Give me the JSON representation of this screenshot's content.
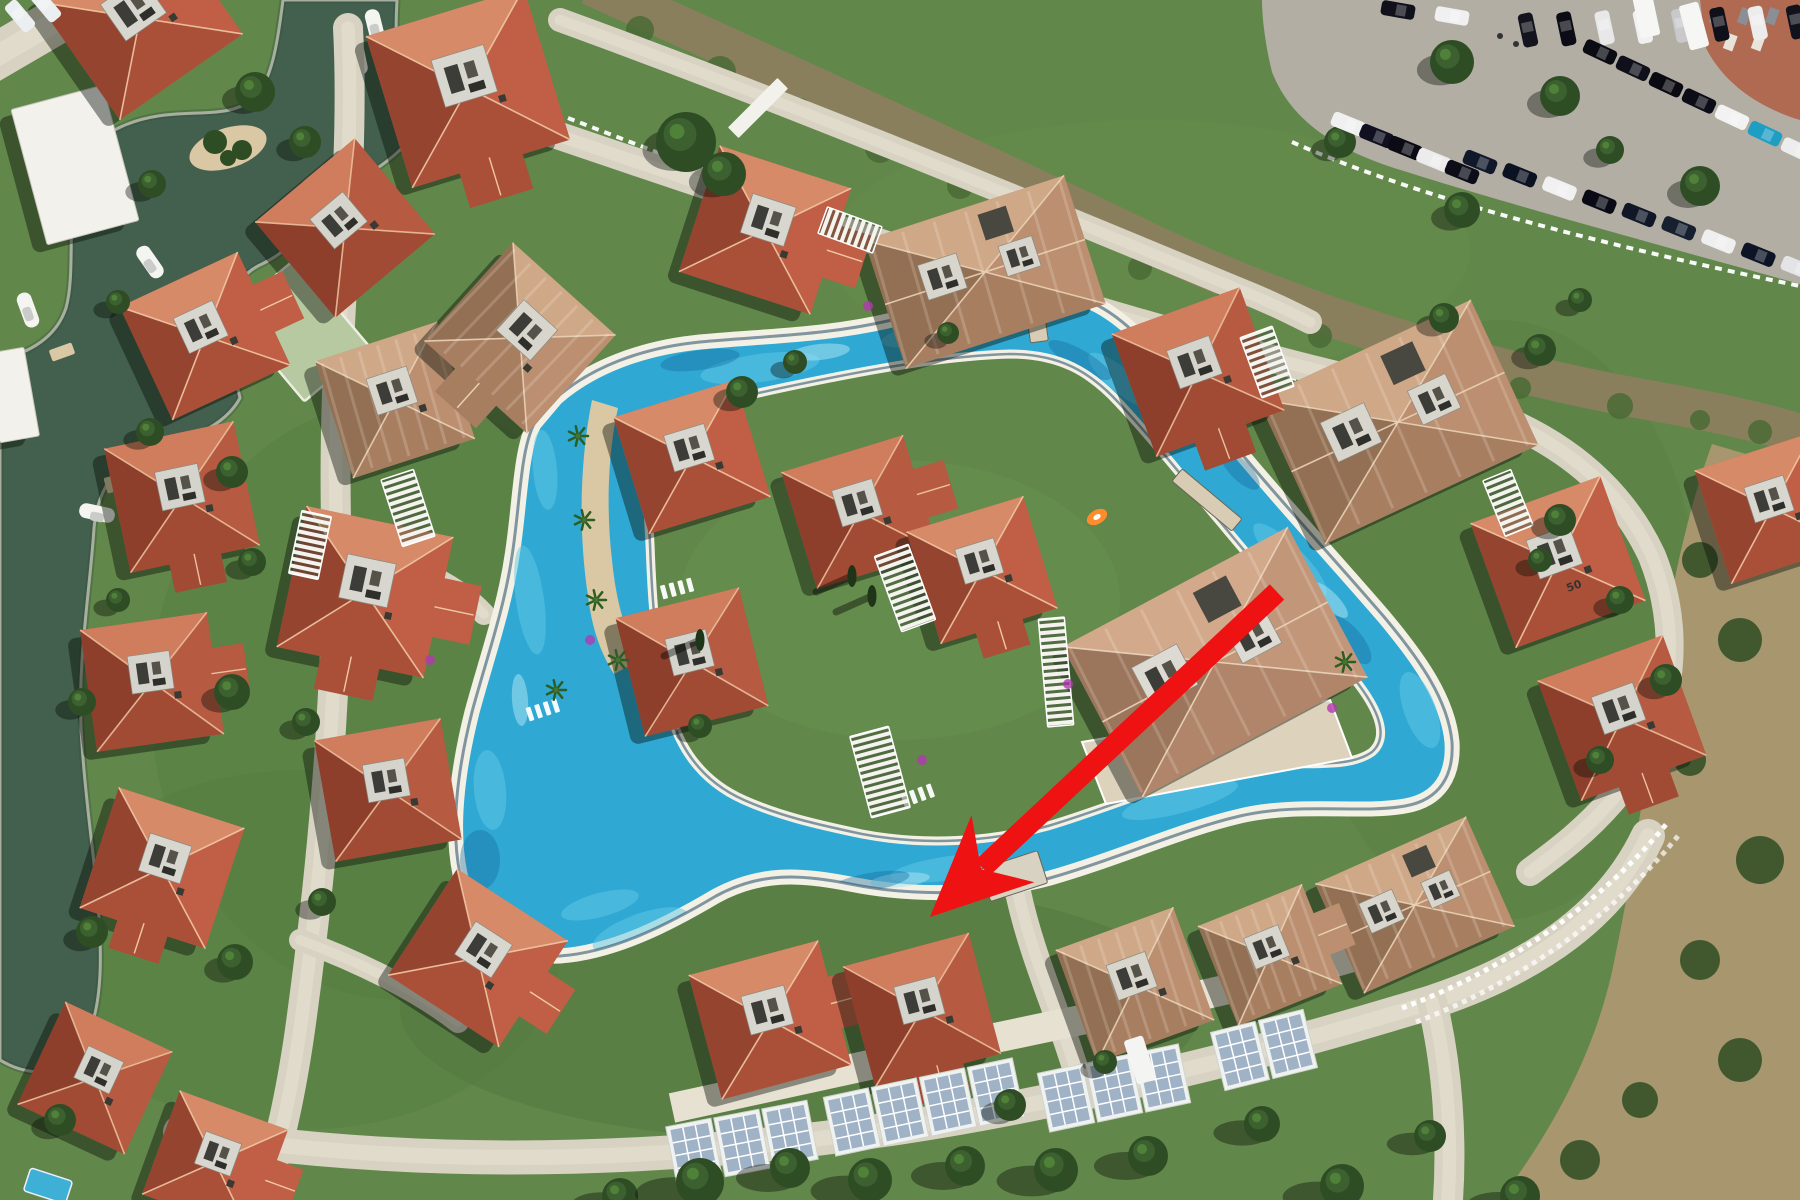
{
  "scene": {
    "w": 1800,
    "h": 1200,
    "description": "aerial-photo-of-resort-with-lazy-river-pool-and-red-arrow"
  },
  "labels": {
    "villa_number": "50"
  },
  "colors": {
    "lawn": "#61874a",
    "lawnDark": "#4e7038",
    "lawnLight": "#719a54",
    "road": "#d8d2c2",
    "roadLight": "#e7e1d2",
    "poolWater": "#2fa9d4",
    "poolLight": "#62c8e6",
    "poolPale": "#a5e2f1",
    "poolDark": "#14699b",
    "coping": "#f3f1e6",
    "poolEdge": "#0f3a58",
    "lagoon": "#435f4d",
    "lagoonDark": "#35503f",
    "sand": "#d9c8a3",
    "creek": "#8a7f5c",
    "asphalt": "#b2aea4",
    "brick": "#b06a52",
    "scrub": "#a7966e",
    "terrace": "#ddd3bd",
    "white": "#f2f1ec",
    "shadow": "rgba(8,14,6,0.42)",
    "arrow": "#ee1212",
    "court": "#b7c9a0",
    "panel": "#9fb2c6",
    "panelFrame": "#f0f2f0",
    "treeDark": "#2f4d24",
    "treeMid": "#3c6030",
    "treeLight": "#558a3b",
    "cypress": "#1e3518",
    "purple": "#b03ab0",
    "carDark": "#10101c",
    "boat": "#f4f4f0"
  },
  "palettes": [
    {
      "base": "#c2664c",
      "f": [
        "#d68a68",
        "#c05f45",
        "#ab5038",
        "#95442f"
      ],
      "ridge": "#f0c8a6",
      "court": "#d7d7cf"
    },
    {
      "base": "#b55a42",
      "f": [
        "#cf7d5c",
        "#b65a41",
        "#a14b35",
        "#8d3f2c"
      ],
      "ridge": "#eabf9d",
      "court": "#d4d4cc"
    },
    {
      "base": "#b08266",
      "f": [
        "#cfa888",
        "#bb8f70",
        "#a87e61",
        "#937054"
      ],
      "ridge": "#ead2b5",
      "court": "#d7d5cc"
    },
    {
      "base": "#c29b7e",
      "f": [
        "#d3a98c",
        "#c29679",
        "#b08569",
        "#9c765c"
      ],
      "ridge": "#ecd6bd",
      "court": "#dcdad2"
    }
  ],
  "lawn_patches": [
    [
      900,
      600,
      300,
      200,
      "#6d9350",
      0.3
    ],
    [
      400,
      700,
      250,
      300,
      "#547a3e",
      0.35
    ],
    [
      1500,
      620,
      200,
      300,
      "#55793e",
      0.3
    ],
    [
      800,
      1010,
      400,
      130,
      "#4e7038",
      0.35
    ],
    [
      1150,
      250,
      320,
      130,
      "#6d9350",
      0.3
    ],
    [
      300,
      950,
      260,
      180,
      "#547a3e",
      0.3
    ]
  ],
  "lagoon": {
    "path": "M 283 0 L 397 0 C 394 52 398 96 418 128 C 400 158 368 172 338 198 C 312 222 292 250 262 264 C 244 272 234 286 230 310 C 228 344 234 372 240 398 C 224 428 186 440 148 452 C 118 462 98 486 94 528 C 90 592 76 668 82 744 C 86 812 98 876 100 940 C 102 992 96 1032 74 1058 C 52 1080 20 1072 0 1060 L 0 360 C 30 352 56 338 66 308 C 76 272 66 214 78 172 C 88 140 120 122 158 116 C 196 110 228 118 252 100 C 272 84 278 40 283 0 Z",
    "island": {
      "x": 228,
      "y": 148,
      "rx": 40,
      "ry": 20,
      "rot": -18
    },
    "island_trees": [
      [
        215,
        142,
        12
      ],
      [
        242,
        150,
        10
      ],
      [
        228,
        158,
        8
      ]
    ],
    "docks": [
      [
        318,
        178,
        -40,
        30,
        14
      ],
      [
        120,
        482,
        -15,
        30,
        16
      ],
      [
        62,
        352,
        -20,
        24,
        12
      ]
    ],
    "boats": [
      [
        358,
        57,
        -12
      ],
      [
        375,
        27,
        -14
      ],
      [
        150,
        262,
        -35
      ],
      [
        97,
        513,
        -78
      ],
      [
        28,
        310,
        -20
      ]
    ]
  },
  "creek": {
    "path": "M 590 -15 C 760 62 960 152 1160 248 C 1320 322 1500 374 1648 400 C 1716 412 1770 424 1805 436",
    "width": 40,
    "blobs": [
      [
        640,
        30,
        14
      ],
      [
        720,
        72,
        16
      ],
      [
        800,
        110,
        12
      ],
      [
        880,
        148,
        15
      ],
      [
        960,
        186,
        13
      ],
      [
        1050,
        226,
        16
      ],
      [
        1140,
        268,
        12
      ],
      [
        1230,
        302,
        15
      ],
      [
        1320,
        336,
        12
      ],
      [
        1420,
        364,
        14
      ],
      [
        1520,
        388,
        11
      ],
      [
        1620,
        406,
        13
      ],
      [
        1700,
        420,
        10
      ],
      [
        1760,
        432,
        12
      ]
    ],
    "fences": [
      "M 568 118 C 770 196 985 278 1205 352 C 1330 392 1440 414 1540 428",
      "M 1292 142 C 1400 190 1560 236 1800 286"
    ]
  },
  "court": {
    "x": 300,
    "y": 330,
    "rot": -40,
    "w": 85,
    "h": 115
  },
  "roads": [
    {
      "d": "M -10 60 L 110 -10",
      "w": 46
    },
    {
      "d": "M 348 28 C 356 180 332 330 336 520 C 340 700 318 900 300 1030 C 290 1100 278 1150 262 1200",
      "w": 30
    },
    {
      "d": "M 180 1132 C 480 1180 800 1156 1080 1094 C 1260 1054 1360 1024 1432 1002 C 1540 966 1612 912 1648 836",
      "w": 34
    },
    {
      "d": "M 1432 1002 C 1448 1068 1452 1140 1448 1200",
      "w": 30
    },
    {
      "d": "M 548 132 C 760 204 980 278 1180 334 C 1290 364 1360 382 1428 396 C 1530 418 1612 470 1652 556 C 1688 646 1666 738 1612 800 C 1586 830 1560 850 1530 872",
      "w": 28
    },
    {
      "d": "M 560 20 C 780 100 1000 190 1240 290 C 1270 302 1290 312 1310 322",
      "w": 24
    },
    {
      "d": "M 336 548 C 404 560 452 580 484 614",
      "w": 22
    },
    {
      "d": "M 300 940 C 360 962 420 992 458 1022",
      "w": 22
    },
    {
      "d": "M 988 742 C 1000 790 1008 838 1016 882 C 1026 936 1048 990 1066 1040 C 1074 1064 1080 1082 1084 1096",
      "w": 26
    }
  ],
  "plaza": "M 756 538 L 985 598 L 1005 700 L 930 762 L 792 748 L 742 640 Z",
  "terrace": "M 1082 742 L 1330 700 L 1352 758 L 1106 804 Z",
  "walkway": "M 672 1108 C 820 1076 980 1040 1140 1008 C 1240 988 1330 966 1420 936",
  "parking": {
    "path": "M 1262 0 L 1800 0 L 1800 284 C 1640 240 1480 196 1388 166 C 1330 146 1290 118 1272 72 C 1266 48 1262 20 1262 0 Z",
    "brick": "M 1700 0 L 1800 0 L 1800 120 C 1760 108 1724 84 1706 48 Z",
    "rows": [
      {
        "x1": 1528,
        "y1": 30,
        "x2": 1796,
        "y2": 22,
        "n": 8,
        "rot": -12,
        "colors": [
          "#14141e",
          "#0c0c16",
          "#e8e8e8",
          "#f0f0f0",
          "#c9c9cc",
          "#10101a",
          "#ececec",
          "#12121c"
        ]
      },
      {
        "x1": 1600,
        "y1": 52,
        "x2": 1798,
        "y2": 150,
        "n": 7,
        "rot": 115,
        "colors": [
          "#0b0b14",
          "#10101c",
          "#0a0a12",
          "#0d0d18",
          "#f2f2f2",
          "#1f9ec4",
          "#ededed"
        ]
      },
      {
        "x1": 1348,
        "y1": 124,
        "x2": 1462,
        "y2": 172,
        "n": 5,
        "rot": 112,
        "colors": [
          "#f0f0f0",
          "#101020",
          "#0b0b16",
          "#ececec",
          "#0d0d1a"
        ]
      },
      {
        "x1": 1480,
        "y1": 162,
        "x2": 1798,
        "y2": 268,
        "n": 9,
        "rot": 112,
        "colors": [
          "#10182a",
          "#0b1222",
          "#f1f1f1",
          "#0a0a16",
          "#101828",
          "#16202f",
          "#efefef",
          "#0c1426",
          "#e4e4e6"
        ]
      },
      {
        "x1": 1398,
        "y1": 10,
        "x2": 1452,
        "y2": 16,
        "n": 2,
        "rot": 100,
        "colors": [
          "#11111c",
          "#f0f0f0"
        ]
      }
    ],
    "vans": [
      [
        1646,
        14,
        -12
      ],
      [
        1694,
        26,
        -15
      ]
    ],
    "trees": [
      [
        1452,
        62,
        22
      ],
      [
        1560,
        96,
        20
      ],
      [
        1340,
        142,
        16
      ],
      [
        1462,
        210,
        18
      ],
      [
        1700,
        186,
        20
      ],
      [
        1610,
        150,
        14
      ]
    ],
    "people": [
      [
        1500,
        36
      ],
      [
        1516,
        44
      ]
    ]
  },
  "scrub": {
    "path": "M 1712 444 L 1800 470 L 1800 1200 L 1500 1200 C 1560 1120 1600 1040 1616 952 C 1636 856 1648 760 1660 664 C 1672 580 1690 504 1712 444 Z",
    "blobs": [
      [
        1700,
        560,
        18
      ],
      [
        1740,
        640,
        22
      ],
      [
        1690,
        760,
        16
      ],
      [
        1760,
        860,
        24
      ],
      [
        1700,
        960,
        20
      ],
      [
        1740,
        1060,
        22
      ],
      [
        1640,
        1100,
        18
      ],
      [
        1580,
        1160,
        20
      ],
      [
        1772,
        500,
        14
      ]
    ]
  },
  "pool": {
    "outer": "M 556 398 C 590 368 640 348 700 342 C 760 336 830 336 900 318 C 945 306 990 294 1032 292 C 1080 290 1110 308 1140 338 C 1170 368 1205 410 1240 452 C 1285 506 1335 560 1385 618 C 1420 660 1448 700 1452 742 C 1454 775 1440 800 1405 806 C 1360 814 1300 802 1240 816 C 1180 830 1120 858 1050 878 C 990 894 920 898 850 884 C 800 874 760 872 716 896 C 672 922 616 952 560 956 C 512 958 472 928 460 874 C 450 826 458 768 472 712 C 486 660 504 610 512 556 C 520 506 520 452 534 424 Z",
    "island": "M 648 428 C 700 404 760 392 830 378 C 890 366 950 356 1010 354 C 1060 354 1090 372 1118 402 C 1150 436 1185 480 1222 524 C 1265 576 1310 626 1352 676 C 1378 708 1390 736 1372 752 C 1344 772 1290 758 1232 768 C 1170 780 1115 806 1048 826 C 990 842 925 846 862 834 C 815 824 780 816 744 800 C 708 784 682 756 670 712 C 656 660 652 600 650 544 C 648 504 644 462 648 428 Z",
    "peninsula": "M 592 400 C 580 460 578 530 588 596 C 592 628 600 652 614 674 L 640 660 C 624 630 616 600 612 560 C 606 510 608 452 618 408 Z",
    "palms": [
      [
        578,
        436
      ],
      [
        584,
        520
      ],
      [
        596,
        600
      ],
      [
        618,
        660
      ],
      [
        556,
        690
      ],
      [
        1345,
        662
      ]
    ],
    "sparkles": [
      [
        760,
        368,
        60,
        14,
        -8
      ],
      [
        950,
        330,
        70,
        13,
        -10
      ],
      [
        1120,
        380,
        40,
        12,
        40
      ],
      [
        1290,
        560,
        50,
        14,
        45
      ],
      [
        1420,
        710,
        40,
        16,
        70
      ],
      [
        1180,
        800,
        60,
        13,
        -15
      ],
      [
        950,
        868,
        60,
        12,
        -8
      ],
      [
        640,
        930,
        50,
        16,
        -20
      ],
      [
        490,
        790,
        16,
        40,
        -5
      ],
      [
        530,
        600,
        14,
        55,
        -8
      ],
      [
        545,
        470,
        12,
        40,
        -5
      ],
      [
        600,
        905,
        40,
        12,
        -15
      ]
    ],
    "pales": [
      [
        820,
        352,
        30,
        8,
        -6
      ],
      [
        1000,
        310,
        34,
        7,
        -8
      ],
      [
        1330,
        600,
        24,
        8,
        45
      ],
      [
        900,
        880,
        30,
        7,
        -6
      ],
      [
        520,
        700,
        8,
        26,
        -4
      ]
    ],
    "darks": [
      [
        700,
        360,
        40,
        10,
        -8
      ],
      [
        1080,
        360,
        36,
        10,
        30
      ],
      [
        1350,
        640,
        30,
        12,
        50
      ],
      [
        870,
        882,
        40,
        9,
        -10
      ],
      [
        480,
        860,
        20,
        30,
        0
      ],
      [
        1240,
        470,
        26,
        10,
        45
      ]
    ],
    "bridges": [
      [
        1035,
        310,
        -8,
        18,
        64,
        0
      ],
      [
        1207,
        500,
        -50,
        16,
        78,
        0
      ],
      [
        1014,
        876,
        72,
        34,
        60,
        1
      ]
    ],
    "loungers": [
      [
        452,
        428,
        -80
      ],
      [
        530,
        714,
        -18
      ],
      [
        664,
        592,
        -15
      ],
      [
        905,
        800,
        -20
      ]
    ],
    "float": {
      "x": 1097,
      "y": 517,
      "color": "#ff8c2a"
    }
  },
  "solar": {
    "panels": [
      [
        694,
        1152,
        -11
      ],
      [
        742,
        1143,
        -11
      ],
      [
        790,
        1134,
        -11
      ],
      [
        852,
        1122,
        -12
      ],
      [
        900,
        1112,
        -12
      ],
      [
        948,
        1102,
        -12
      ],
      [
        996,
        1092,
        -12
      ],
      [
        1066,
        1098,
        -12
      ],
      [
        1114,
        1088,
        -12
      ],
      [
        1162,
        1078,
        -12
      ],
      [
        1240,
        1056,
        -14
      ],
      [
        1288,
        1044,
        -14
      ]
    ],
    "van": [
      1140,
      1060,
      -18
    ]
  },
  "fences2": [
    "M 1402 1008 C 1500 972 1600 906 1668 822",
    "M 1416 1022 C 1512 986 1610 920 1678 836"
  ],
  "white_buildings": [
    [
      75,
      165,
      -15,
      95,
      140
    ],
    [
      12,
      395,
      -10,
      40,
      90
    ]
  ],
  "big_buildings": [
    [
      1215,
      662,
      -28,
      255,
      170,
      3
    ],
    [
      1398,
      422,
      -25,
      235,
      160,
      2
    ],
    [
      985,
      272,
      -18,
      210,
      135,
      2
    ],
    [
      1415,
      905,
      -24,
      165,
      120,
      2
    ]
  ],
  "villas": [
    [
      140,
      18,
      -35,
      150,
      0,
      "e"
    ],
    [
      468,
      88,
      -17,
      165,
      0,
      "s"
    ],
    [
      345,
      228,
      -40,
      130,
      1,
      ""
    ],
    [
      205,
      336,
      -25,
      130,
      0,
      "e"
    ],
    [
      182,
      497,
      -12,
      132,
      1,
      "s"
    ],
    [
      395,
      400,
      -18,
      128,
      2,
      ""
    ],
    [
      365,
      592,
      12,
      150,
      0,
      "es"
    ],
    [
      152,
      682,
      -8,
      128,
      1,
      "e"
    ],
    [
      162,
      868,
      18,
      132,
      0,
      "s"
    ],
    [
      388,
      790,
      -10,
      128,
      1,
      ""
    ],
    [
      478,
      958,
      33,
      132,
      0,
      "e"
    ],
    [
      95,
      1078,
      25,
      118,
      1,
      ""
    ],
    [
      215,
      1162,
      20,
      115,
      0,
      "e"
    ],
    [
      520,
      338,
      42,
      138,
      2,
      "s"
    ],
    [
      765,
      230,
      18,
      138,
      0,
      "e"
    ],
    [
      1198,
      372,
      -20,
      136,
      1,
      "s"
    ],
    [
      692,
      457,
      -17,
      127,
      0,
      ""
    ],
    [
      860,
      512,
      -17,
      127,
      1,
      "e"
    ],
    [
      982,
      570,
      -17,
      122,
      0,
      "s"
    ],
    [
      692,
      662,
      -14,
      127,
      1,
      ""
    ],
    [
      770,
      1020,
      -15,
      134,
      0,
      "e"
    ],
    [
      922,
      1010,
      -15,
      130,
      1,
      "s"
    ],
    [
      1135,
      985,
      -20,
      125,
      2,
      ""
    ],
    [
      1270,
      955,
      -22,
      112,
      2,
      "e"
    ],
    [
      1558,
      562,
      -20,
      138,
      0,
      ""
    ],
    [
      1622,
      718,
      -20,
      133,
      1,
      "s"
    ],
    [
      1772,
      508,
      -18,
      124,
      0,
      ""
    ]
  ],
  "villa_number_pos": [
    1568,
    592,
    -20
  ],
  "pergolas": [
    [
      408,
      508,
      -18,
      34,
      70
    ],
    [
      310,
      545,
      12,
      30,
      64
    ],
    [
      850,
      230,
      -70,
      28,
      58
    ],
    [
      1267,
      362,
      -20,
      34,
      64
    ],
    [
      1508,
      503,
      -22,
      30,
      60
    ],
    [
      905,
      588,
      -20,
      36,
      80
    ],
    [
      1056,
      672,
      -5,
      26,
      108
    ],
    [
      880,
      772,
      -15,
      40,
      84
    ]
  ],
  "gates": [
    [
      758,
      108,
      15,
      70,
      45
    ]
  ],
  "trees": [
    [
      255,
      92,
      20
    ],
    [
      305,
      142,
      16
    ],
    [
      152,
      184,
      14
    ],
    [
      118,
      302,
      12
    ],
    [
      150,
      432,
      14
    ],
    [
      232,
      472,
      16
    ],
    [
      252,
      562,
      14
    ],
    [
      118,
      600,
      12
    ],
    [
      82,
      702,
      14
    ],
    [
      232,
      692,
      18
    ],
    [
      306,
      722,
      14
    ],
    [
      92,
      932,
      16
    ],
    [
      235,
      962,
      18
    ],
    [
      322,
      902,
      14
    ],
    [
      60,
      1120,
      16
    ],
    [
      686,
      142,
      30
    ],
    [
      724,
      174,
      22
    ],
    [
      742,
      392,
      16
    ],
    [
      795,
      362,
      12
    ],
    [
      948,
      333,
      11
    ],
    [
      700,
      726,
      12
    ],
    [
      1560,
      520,
      16
    ],
    [
      1620,
      600,
      14
    ],
    [
      1666,
      680,
      16
    ],
    [
      1600,
      760,
      14
    ],
    [
      1540,
      560,
      12
    ],
    [
      1010,
      1105,
      16
    ],
    [
      1105,
      1062,
      12
    ],
    [
      1540,
      350,
      16
    ],
    [
      1580,
      300,
      12
    ],
    [
      1444,
      318,
      15
    ]
  ],
  "row_trees": [
    [
      620,
      1196,
      18
    ],
    [
      700,
      1182,
      24
    ],
    [
      790,
      1168,
      20
    ],
    [
      870,
      1180,
      22
    ],
    [
      965,
      1166,
      20
    ],
    [
      1056,
      1170,
      22
    ],
    [
      1148,
      1156,
      20
    ],
    [
      1262,
      1124,
      18
    ],
    [
      1342,
      1186,
      22
    ],
    [
      1430,
      1136,
      16
    ],
    [
      1520,
      1196,
      20
    ]
  ],
  "cypresses": [
    [
      852,
      576
    ],
    [
      872,
      596
    ],
    [
      700,
      640
    ]
  ],
  "bougainvillea": [
    [
      1068,
      684
    ],
    [
      1332,
      708
    ],
    [
      922,
      760
    ],
    [
      868,
      306
    ],
    [
      590,
      640
    ],
    [
      430,
      660
    ]
  ],
  "small_pool": [
    48,
    1186,
    18,
    44,
    24
  ],
  "corner_cars": [
    [
      20,
      16,
      -40
    ],
    [
      46,
      6,
      -40
    ]
  ],
  "arrow": {
    "tail": [
      1277,
      592
    ],
    "tip": [
      930,
      917
    ],
    "width": 21,
    "head_len": 100,
    "head_halfw": 46,
    "notch": 70
  }
}
